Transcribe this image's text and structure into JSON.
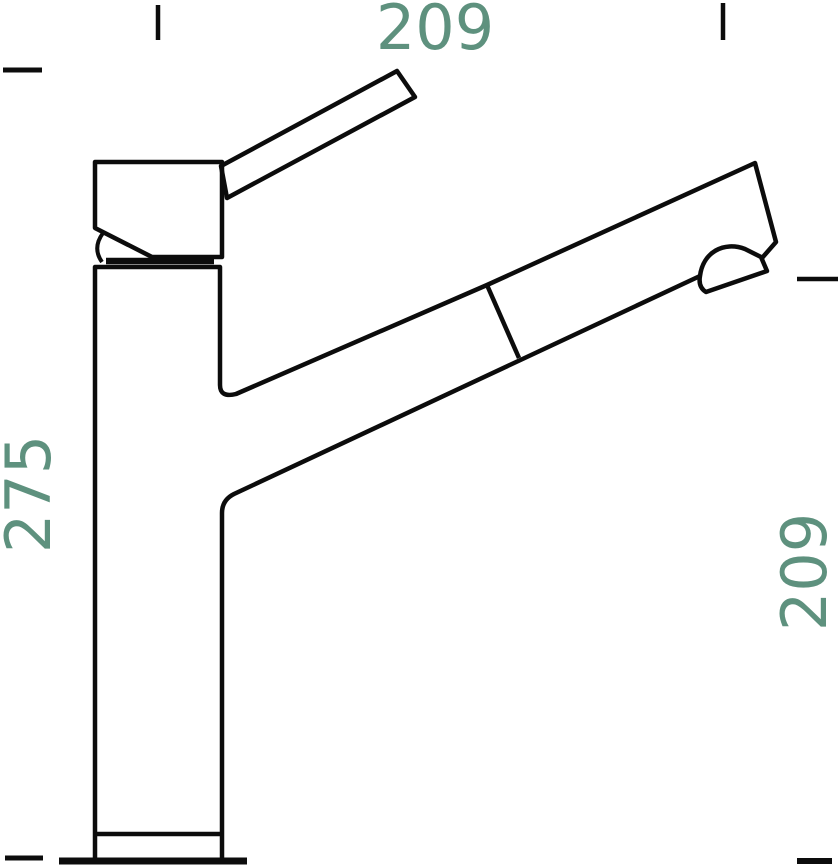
{
  "page": {
    "background_color": "#ffffff"
  },
  "drawing": {
    "subject": "pull-out-spray kitchen faucet, side view technical drawing",
    "line_color": "#0c0c0c",
    "dimension_text_color": "#5e917e",
    "dimensions": {
      "top": {
        "value": "209",
        "orientation": "horizontal"
      },
      "left": {
        "value": "275",
        "orientation": "vertical"
      },
      "right": {
        "value": "209",
        "orientation": "vertical"
      }
    }
  }
}
